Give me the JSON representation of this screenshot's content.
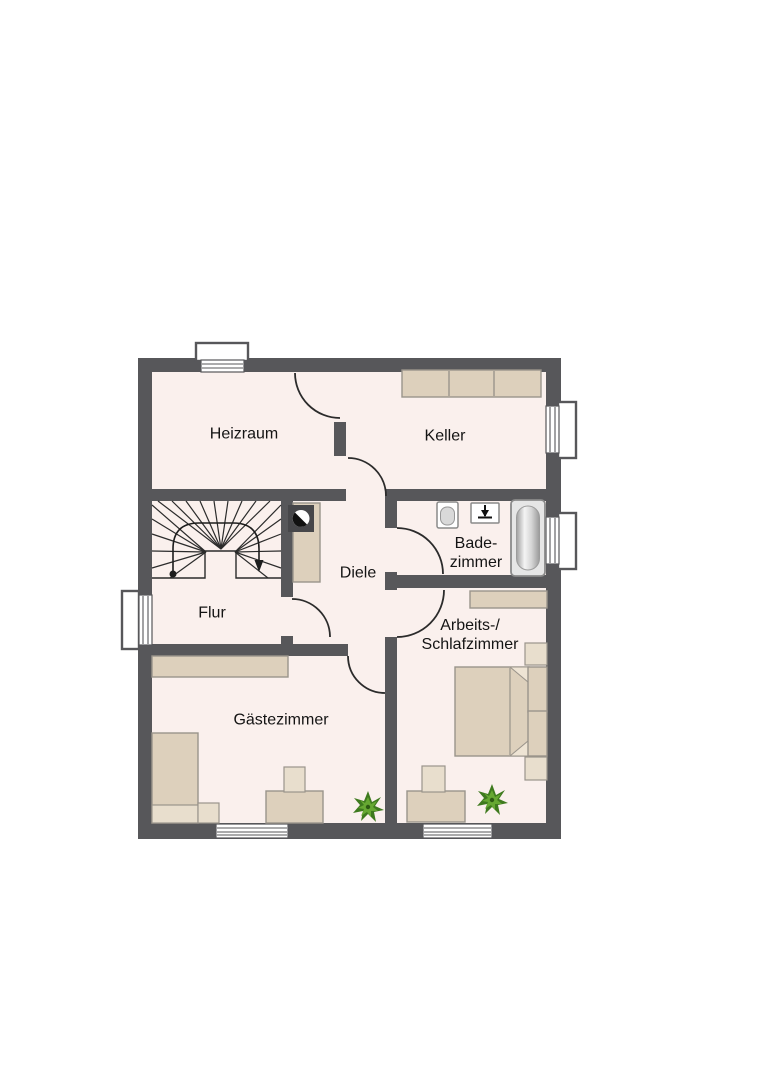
{
  "floor_plan": {
    "rooms": [
      {
        "id": "heizraum",
        "name": "Heizraum"
      },
      {
        "id": "keller",
        "name": "Keller"
      },
      {
        "id": "badezimmer",
        "name_line1": "Bade-",
        "name_line2": "zimmer"
      },
      {
        "id": "diele",
        "name": "Diele"
      },
      {
        "id": "flur",
        "name": "Flur"
      },
      {
        "id": "arbeits_schlafzimmer",
        "name_line1": "Arbeits-/",
        "name_line2": "Schlafzimmer"
      },
      {
        "id": "gaestezimmer",
        "name": "Gästezimmer"
      }
    ],
    "fixtures": {
      "keller": [
        "shelf-unit"
      ],
      "badezimmer": [
        "toilet",
        "washbasin",
        "bathtub"
      ],
      "diele": [
        "cabinet",
        "decor-sphere"
      ],
      "flur": [
        "winder-staircase"
      ],
      "gaestezimmer": [
        "wall-shelf",
        "single-bed",
        "nightstand",
        "desk",
        "chair",
        "plant"
      ],
      "arbeits_schlafzimmer": [
        "wall-shelf",
        "double-bed",
        "nightstand",
        "nightstand",
        "desk",
        "chair",
        "plant"
      ],
      "windows": [
        "top-wall",
        "right-wall-keller",
        "right-wall-bad",
        "left-wall-flur",
        "bottom-wall-gaeste",
        "bottom-wall-schlafzimmer"
      ]
    },
    "colors": {
      "wall": "#57575a",
      "floor": "#faf0ed",
      "furniture_beige": "#ddd0bc",
      "furniture_light": "#e8decd",
      "plant_green_dark": "#3e7a1e",
      "plant_green_light": "#66a832"
    }
  }
}
